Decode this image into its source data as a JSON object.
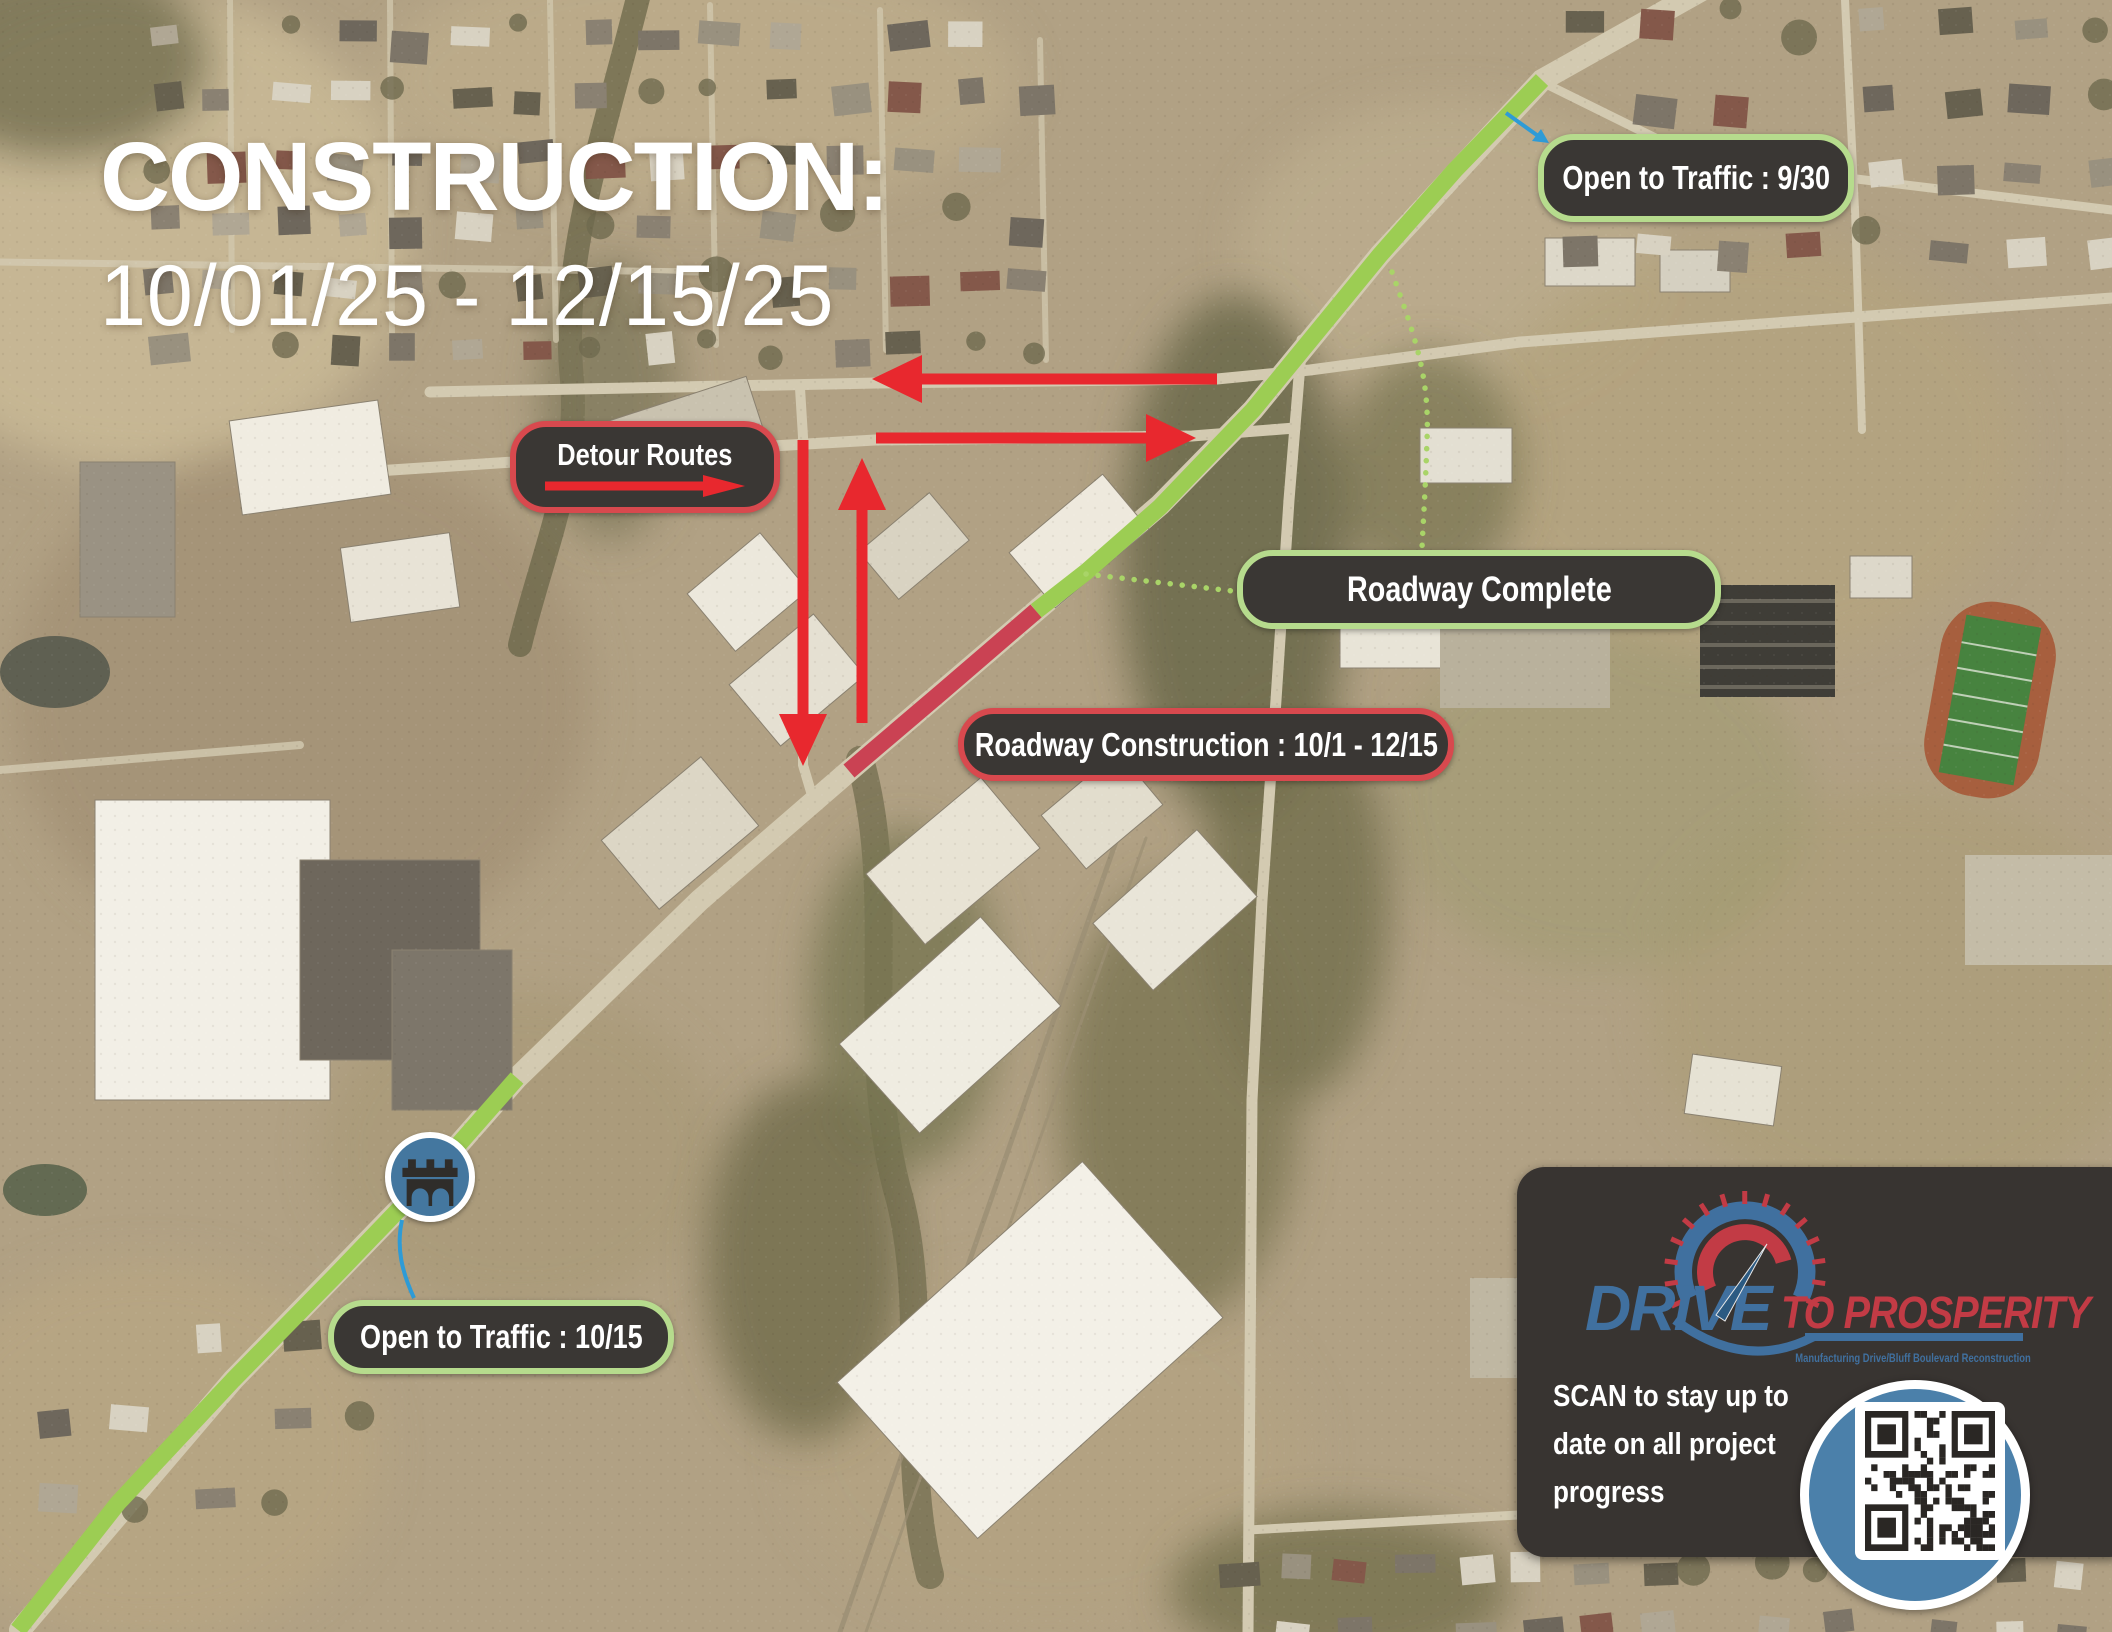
{
  "title": {
    "line1": "CONSTRUCTION:",
    "line2": "10/01/25 - 12/15/25"
  },
  "labels": {
    "open_930": "Open to Traffic : 9/30",
    "detour": "Detour Routes",
    "complete": "Roadway Complete",
    "construction": "Roadway Construction : 10/1 - 12/15",
    "open_1015": "Open to Traffic : 10/15"
  },
  "routes": [
    {
      "id": "north-segment",
      "color": "green",
      "status_label": "Open to Traffic : 9/30"
    },
    {
      "id": "central-segment",
      "color": "red",
      "status_label": "Roadway Construction : 10/1 - 12/15"
    },
    {
      "id": "south-segment",
      "color": "green",
      "status_label": "Open to Traffic : 10/15"
    }
  ],
  "brand": {
    "drive": "DRIVE",
    "to_prosperity": "TO PROSPERITY",
    "tagline": "Manufacturing Drive/Bluff Boulevard Reconstruction"
  },
  "scan": {
    "bold": "SCAN",
    "line1_rest": " to stay up to",
    "line2": "date on all project",
    "line3": "progress"
  },
  "colors": {
    "route_open_green": "#9ccd53",
    "route_construction_red": "#ca4253",
    "detour_arrow_red": "#e8282e",
    "label_background": "#3a3734",
    "label_border_green": "#b6db8d",
    "label_border_red": "#d8494e",
    "brand_blue": "#40709f",
    "brand_red": "#c23b45",
    "qr_circle_blue": "#4b80aa",
    "panel_background": "#383431"
  }
}
